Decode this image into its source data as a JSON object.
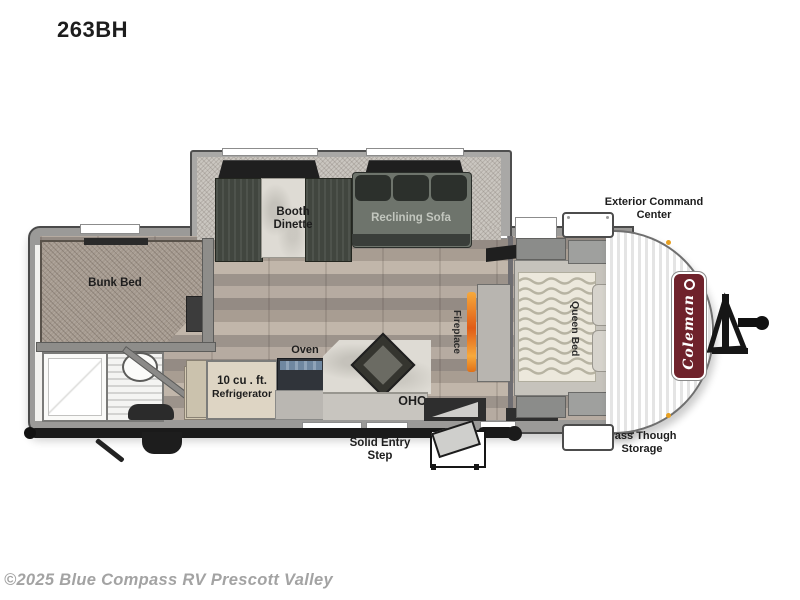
{
  "page": {
    "title": "263BH",
    "watermark": "©2025 Blue Compass RV Prescott Valley"
  },
  "floorplan": {
    "slideout": {
      "booth_dinette_line1": "Booth",
      "booth_dinette_line2": "Dinette",
      "reclining_sofa": "Reclining Sofa"
    },
    "rooms": {
      "bunk_bed": "Bunk Bed",
      "queen_bed": "Queen Bed",
      "fireplace": "Fireplace"
    },
    "kitchen": {
      "oven": "Oven",
      "refrigerator_line1": "10 cu . ft.",
      "refrigerator_line2": "Refrigerator",
      "ohc": "OHC"
    },
    "exterior": {
      "solid_entry_step_line1": "Solid Entry",
      "solid_entry_step_line2": "Step",
      "exterior_command_center_line1": "Exterior Command",
      "exterior_command_center_line2": "Center",
      "pass_through_storage_line1": "Pass Though",
      "pass_through_storage_line2": "Storage",
      "brand": "Coleman"
    },
    "colors": {
      "brand_badge_red": "#6f222b",
      "fireplace_glow_orange": "#e8731f",
      "clearance_light_amber": "#e8a020",
      "wall_gray": "#9b9a98",
      "label_text": "#1d1d1d",
      "watermark_gray": "#a3a3a3"
    }
  }
}
